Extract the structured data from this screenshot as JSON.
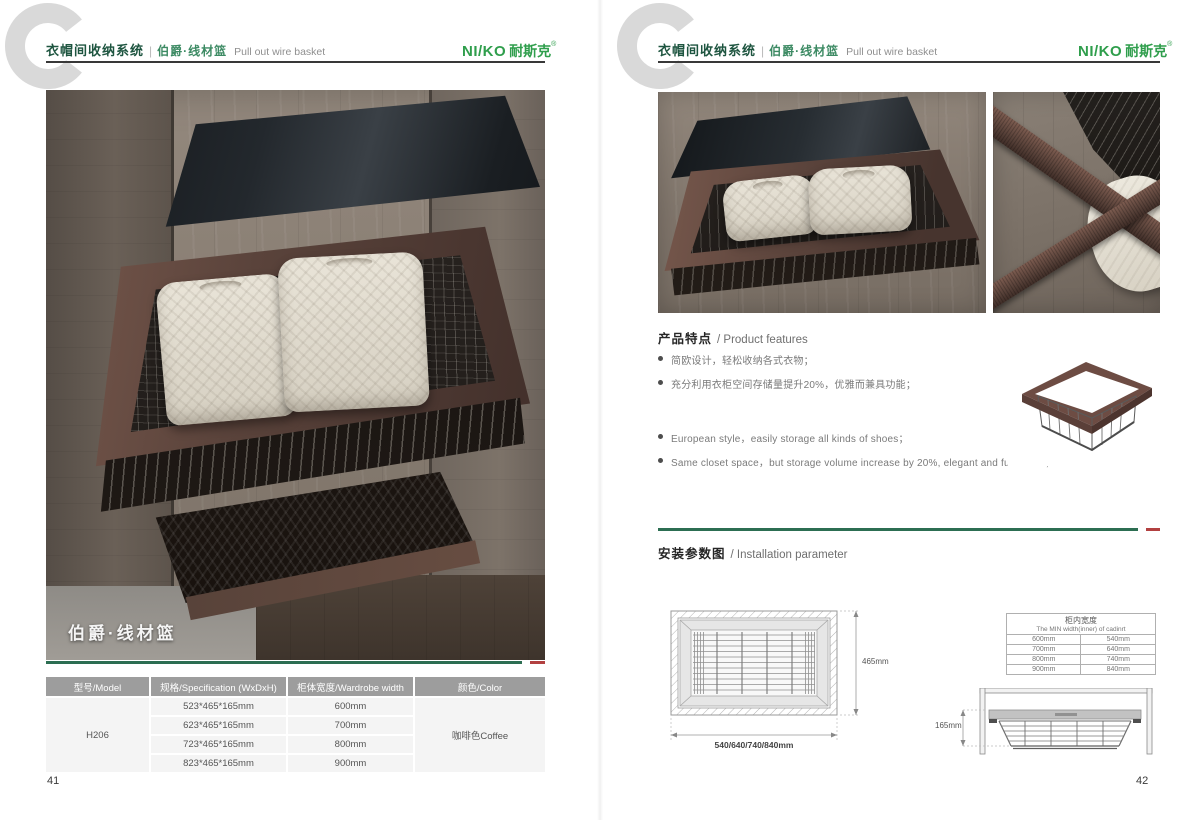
{
  "header": {
    "watermark": "C",
    "title_cn": "衣帽间收纳系统",
    "divider": "|",
    "subtitle_cn": "伯爵·线材篮",
    "subtitle_en": "Pull out wire basket",
    "logo_latin": "NI/KO",
    "logo_cn": "耐斯克",
    "logo_registered": "®"
  },
  "colors": {
    "brand_green": "#2f9e4c",
    "title_green": "#1e5540",
    "accent_green": "#2c6e52",
    "accent_red": "#b24040",
    "coffee_frame": "#5a433b",
    "table_header_gray": "#9d9d9d"
  },
  "left_page": {
    "photo_caption": "伯爵·线材篮",
    "spec_table": {
      "headers": [
        "型号/Model",
        "规格/Specification (WxDxH)",
        "柜体宽度/Wardrobe width",
        "颜色/Color"
      ],
      "model": "H206",
      "color": "咖啡色Coffee",
      "rows": [
        {
          "spec": "523*465*165mm",
          "width": "600mm"
        },
        {
          "spec": "623*465*165mm",
          "width": "700mm"
        },
        {
          "spec": "723*465*165mm",
          "width": "800mm"
        },
        {
          "spec": "823*465*165mm",
          "width": "900mm"
        }
      ]
    },
    "page_number": "41"
  },
  "right_page": {
    "features": {
      "title_cn": "产品特点",
      "title_en": "/ Product features",
      "bullets_cn": [
        "简欧设计，轻松收纳各式衣物；",
        "充分利用衣柜空间存储量提升20%，优雅而兼具功能；"
      ],
      "bullets_en": [
        "European style，easily storage all kinds of shoes；",
        "Same closet space，but storage volume increase by 20%, elegant and functional;"
      ]
    },
    "install": {
      "title_cn": "安装参数图",
      "title_en": "/ Installation parameter",
      "top_view": {
        "depth_label": "465mm",
        "width_label": "540/640/740/840mm"
      },
      "front_view": {
        "height_label": "165mm"
      },
      "min_width_table": {
        "title_cn": "柜内宽度",
        "title_en": "The MIN width(inner) of cadinrt",
        "rows": [
          {
            "wardrobe": "600mm",
            "inner": "540mm"
          },
          {
            "wardrobe": "700mm",
            "inner": "640mm"
          },
          {
            "wardrobe": "800mm",
            "inner": "740mm"
          },
          {
            "wardrobe": "900mm",
            "inner": "840mm"
          }
        ]
      }
    },
    "page_number": "42"
  }
}
